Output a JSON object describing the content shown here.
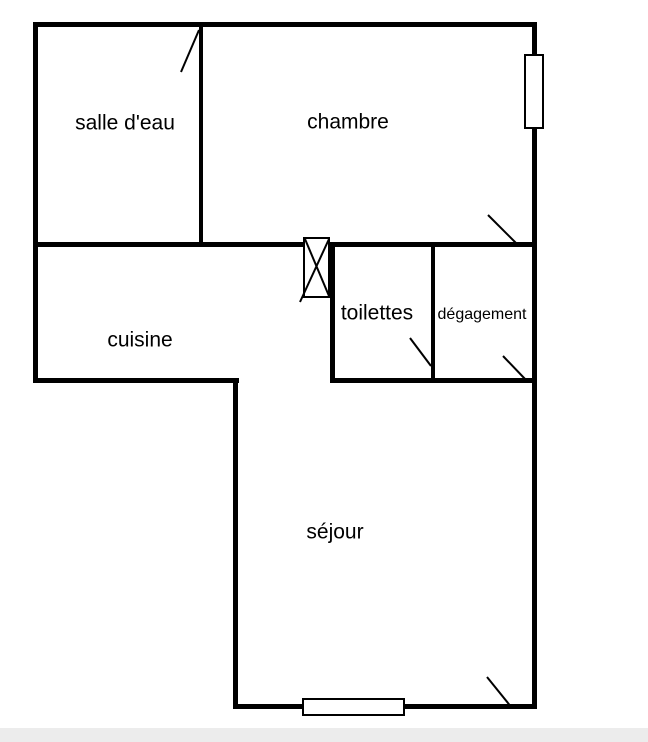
{
  "plan": {
    "type": "apartment-floor-plan",
    "background_color": "#ffffff",
    "wall_color": "#000000",
    "footer_bar_color": "#ececec"
  },
  "rooms": [
    {
      "id": "salle-deau",
      "label": "salle d'eau"
    },
    {
      "id": "chambre",
      "label": "chambre"
    },
    {
      "id": "cuisine",
      "label": "cuisine"
    },
    {
      "id": "toilettes",
      "label": "toilettes"
    },
    {
      "id": "degagement",
      "label": "dégagement"
    },
    {
      "id": "sejour",
      "label": "séjour"
    }
  ],
  "symbols": {
    "windows": 2,
    "door_swings": 5,
    "duct_boxes": 1
  }
}
